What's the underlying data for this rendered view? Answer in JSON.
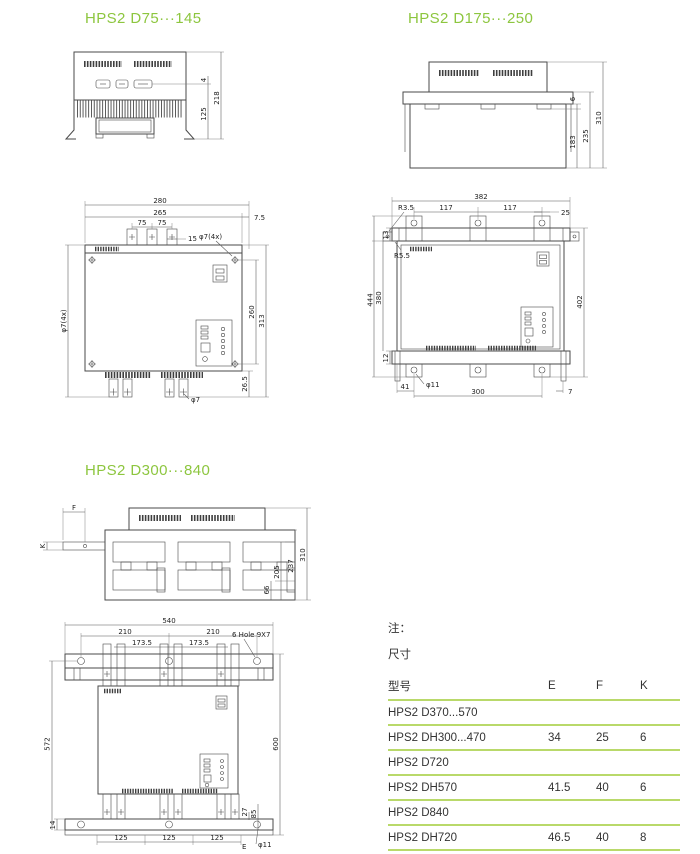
{
  "page": {
    "bg": "#ffffff",
    "accent_green": "#8dc63f",
    "table_line_green": "#b9d96a",
    "ink": "#4a4a4a"
  },
  "sections": {
    "s1": {
      "title": "HPS2 D75···145"
    },
    "s2": {
      "title": "HPS2 D175···250"
    },
    "s3": {
      "title": "HPS2 D300···840"
    }
  },
  "dims": {
    "s1": {
      "d4": "4",
      "d125": "125",
      "d218": "218"
    },
    "s2": {
      "d6": "6",
      "d183": "183",
      "d235": "235",
      "d310": "310"
    },
    "f1": {
      "d280": "280",
      "d265": "265",
      "d7_5": "7.5",
      "d75a": "75",
      "d75b": "75",
      "d15": "15",
      "hole_tr": "φ7(4x)",
      "hole_l": "φ7(4x)",
      "d260": "260",
      "d313": "313",
      "d26_5": "26.5",
      "d7": "φ7"
    },
    "f2": {
      "d382": "382",
      "d117a": "117",
      "d117b": "117",
      "d25": "25",
      "r35": "R3.5",
      "r55": "R5.5",
      "d13": "13",
      "d380": "380",
      "d444": "444",
      "d12": "12",
      "d402": "402",
      "d41": "41",
      "d300": "300",
      "d7": "7",
      "d11": "φ11"
    },
    "s3": {
      "f": "F",
      "k": "K",
      "d66": "66",
      "d205": "205",
      "d237": "237",
      "d310": "310"
    },
    "f3": {
      "d540": "540",
      "d210a": "210",
      "d210b": "210",
      "d173a": "173.5",
      "d173b": "173.5",
      "holes": "6 Hole 9X7",
      "d572": "572",
      "d600": "600",
      "d14": "14",
      "d27": "27",
      "d85": "85",
      "d125a": "125",
      "d125b": "125",
      "d125c": "125",
      "d11": "φ11",
      "e": "E"
    }
  },
  "table": {
    "note": "注：",
    "size_label": "尺寸",
    "col_model": "型号",
    "col_e": "E",
    "col_f": "F",
    "col_k": "K",
    "rows": [
      {
        "model": "HPS2 D370...570",
        "e": "",
        "f": "",
        "k": ""
      },
      {
        "model": "HPS2 DH300...470",
        "e": "34",
        "f": "25",
        "k": "6"
      },
      {
        "model": "HPS2 D720",
        "e": "",
        "f": "",
        "k": ""
      },
      {
        "model": "HPS2 DH570",
        "e": "41.5",
        "f": "40",
        "k": "6"
      },
      {
        "model": "HPS2 D840",
        "e": "",
        "f": "",
        "k": ""
      },
      {
        "model": "HPS2 DH720",
        "e": "46.5",
        "f": "40",
        "k": "8"
      }
    ]
  }
}
